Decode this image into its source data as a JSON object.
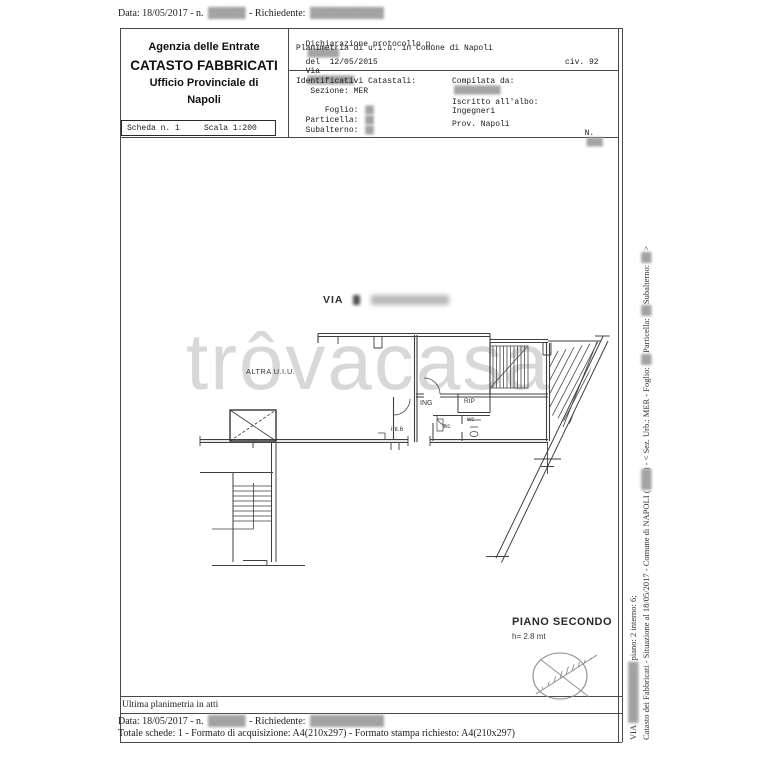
{
  "redactions": {
    "xs": "██",
    "s": "████",
    "m": "██████",
    "l": "████████",
    "xl": "████████████"
  },
  "top_meta": {
    "data_label": "Data: 18/05/2017 - n.",
    "richiedente_label": "- Richiedente:"
  },
  "header": {
    "agency": {
      "line1": "Agenzia delle Entrate",
      "line2": "CATASTO FABBRICATI",
      "line3": "Ufficio Provinciale di",
      "line4": "Napoli"
    },
    "scheda": {
      "scheda": "Scheda n. 1",
      "scala": "Scala 1:200"
    },
    "declaration": {
      "protocollo": "Dichiarazione protocollo n.",
      "del": "del  12/05/2015",
      "planimetria": "Planimetria di u.i.u. in Comune di Napoli",
      "via": "Via",
      "civ": "civ. 92"
    },
    "catastali": {
      "title": "Identificativi Catastali:",
      "sezione": "   Sezione: MER",
      "foglio": "    Foglio: ",
      "particella": "Particella: ",
      "subalterno": "Subalterno: "
    },
    "compilata": {
      "title": "Compilata da:",
      "albo": "Iscritto all'albo:",
      "albo2": "Ingegneri",
      "prov": "Prov. Napoli",
      "n": "N."
    }
  },
  "plan": {
    "street": "VIA",
    "altra_uiu": "ALTRA U.I.U.",
    "ing": "ING",
    "rip": "RIP",
    "wc1": "wc",
    "wc2": "wc",
    "int6": "int.6",
    "piano": "PIANO SECONDO",
    "altezza": "h= 2.8 mt"
  },
  "watermark": "trôvacasa",
  "footer": {
    "ultima": "Ultima planimetria in atti",
    "data_label": "Data: 18/05/2017 - n.",
    "richiedente_label": "- Richiedente:",
    "totale": "Totale schede: 1 - Formato di acquisizione: A4(210x297)  - Formato stampa richiesto: A4(210x297)"
  },
  "side": {
    "l1a": "Catasto dei Fabbricati - Situazione al 18/05/2017 - Comune di NAPOLI (",
    "l1b": ") - < Sez. Urb.: MER - Foglio:",
    "l1c": "Particella:",
    "l1d": "Subalterno:",
    "l1e": ">",
    "l2a": "VIA",
    "l2b": "piano: 2 interno: 6;"
  }
}
